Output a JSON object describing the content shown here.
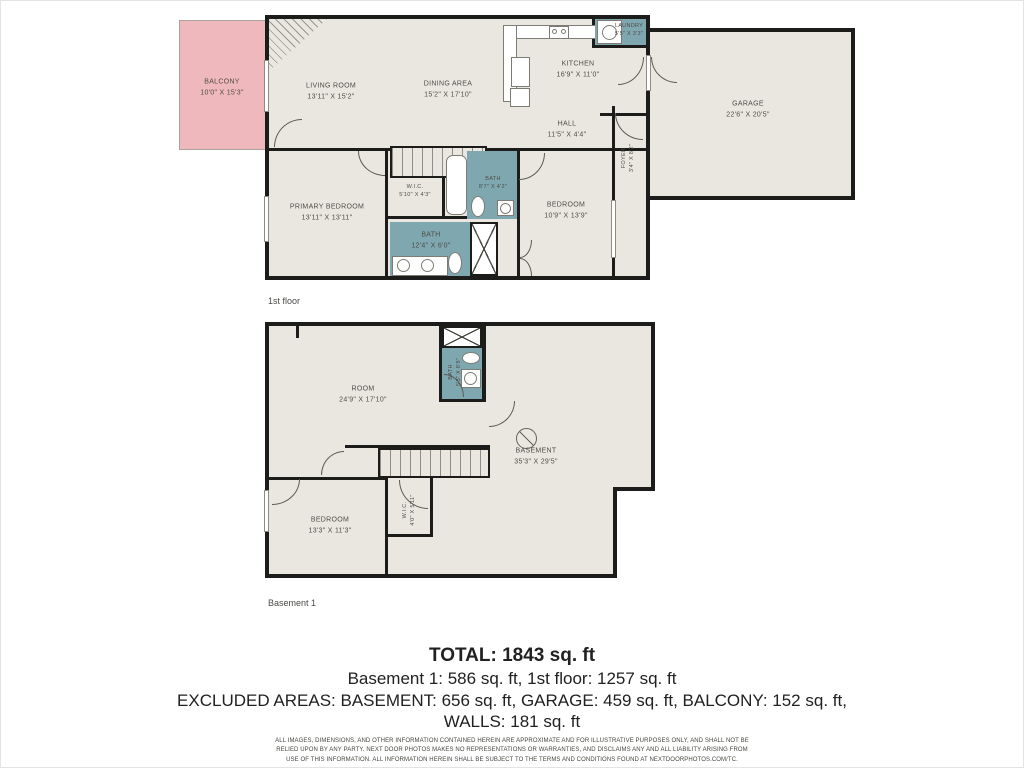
{
  "colors": {
    "floor_fill": "#e9e7e0",
    "wall": "#1c1c1a",
    "balcony_fill": "#efb8bc",
    "wet_area_fill": "#7fa7b0",
    "label_text": "#4f4d46",
    "summary_text": "#212121"
  },
  "floors": [
    {
      "label": "1st floor",
      "rooms": [
        {
          "id": "balcony",
          "label": "BALCONY",
          "dim": "10'0\" X 15'3\""
        },
        {
          "id": "living-room",
          "label": "LIVING ROOM",
          "dim": "13'11\" X 15'2\""
        },
        {
          "id": "dining-area",
          "label": "DINING AREA",
          "dim": "15'2\" X 17'10\""
        },
        {
          "id": "kitchen",
          "label": "KITCHEN",
          "dim": "16'9\" X 11'0\""
        },
        {
          "id": "laundry",
          "label": "LAUNDRY",
          "dim": "5'5\" X 3'3\""
        },
        {
          "id": "hall",
          "label": "HALL",
          "dim": "11'5\" X 4'4\""
        },
        {
          "id": "foyer",
          "label": "FOYER",
          "dim": "3'4\" X 8'2\""
        },
        {
          "id": "garage",
          "label": "GARAGE",
          "dim": "22'6\" X 20'5\""
        },
        {
          "id": "primary-bedroom",
          "label": "PRIMARY BEDROOM",
          "dim": "13'11\" X 13'11\""
        },
        {
          "id": "wic",
          "label": "W.I.C.",
          "dim": "5'10\" X 4'3\""
        },
        {
          "id": "bath-small",
          "label": "BATH",
          "dim": "8'7\" X 4'2\""
        },
        {
          "id": "bath-large",
          "label": "BATH",
          "dim": "12'4\" X 6'0\""
        },
        {
          "id": "bedroom",
          "label": "BEDROOM",
          "dim": "10'9\" X 13'9\""
        }
      ]
    },
    {
      "label": "Basement 1",
      "rooms": [
        {
          "id": "room",
          "label": "ROOM",
          "dim": "24'9\" X 17'10\""
        },
        {
          "id": "bath",
          "label": "BATH",
          "dim": "5'3\" X 8'8\""
        },
        {
          "id": "basement",
          "label": "BASEMENT",
          "dim": "35'3\" X 29'5\""
        },
        {
          "id": "bedroom",
          "label": "BEDROOM",
          "dim": "13'3\" X 11'3\""
        },
        {
          "id": "wic",
          "label": "W.I.C.",
          "dim": "4'0\" X 5'11\""
        }
      ]
    }
  ],
  "summary": {
    "total": "TOTAL: 1843 sq. ft",
    "line2": "Basement 1: 586 sq. ft, 1st floor: 1257 sq. ft",
    "line3": "EXCLUDED AREAS: BASEMENT: 656 sq. ft, GARAGE: 459 sq. ft, BALCONY: 152 sq. ft,",
    "line4": "WALLS: 181 sq. ft",
    "disclaimer_1": "ALL IMAGES, DIMENSIONS, AND OTHER INFORMATION CONTAINED HEREIN ARE APPROXIMATE AND FOR ILLUSTRATIVE PURPOSES ONLY, AND SHALL NOT BE RELIED UPON BY ANY PARTY.",
    "disclaimer_2": "NEXT DOOR PHOTOS MAKES NO REPRESENTATIONS OR WARRANTIES, AND DISCLAIMS ANY AND ALL LIABILITY ARISING FROM USE OF THIS INFORMATION. ALL INFORMATION HEREIN",
    "disclaimer_3": "SHALL BE SUBJECT TO THE TERMS AND CONDITIONS FOUND AT NEXTDOORPHOTOS.COM/TC."
  }
}
